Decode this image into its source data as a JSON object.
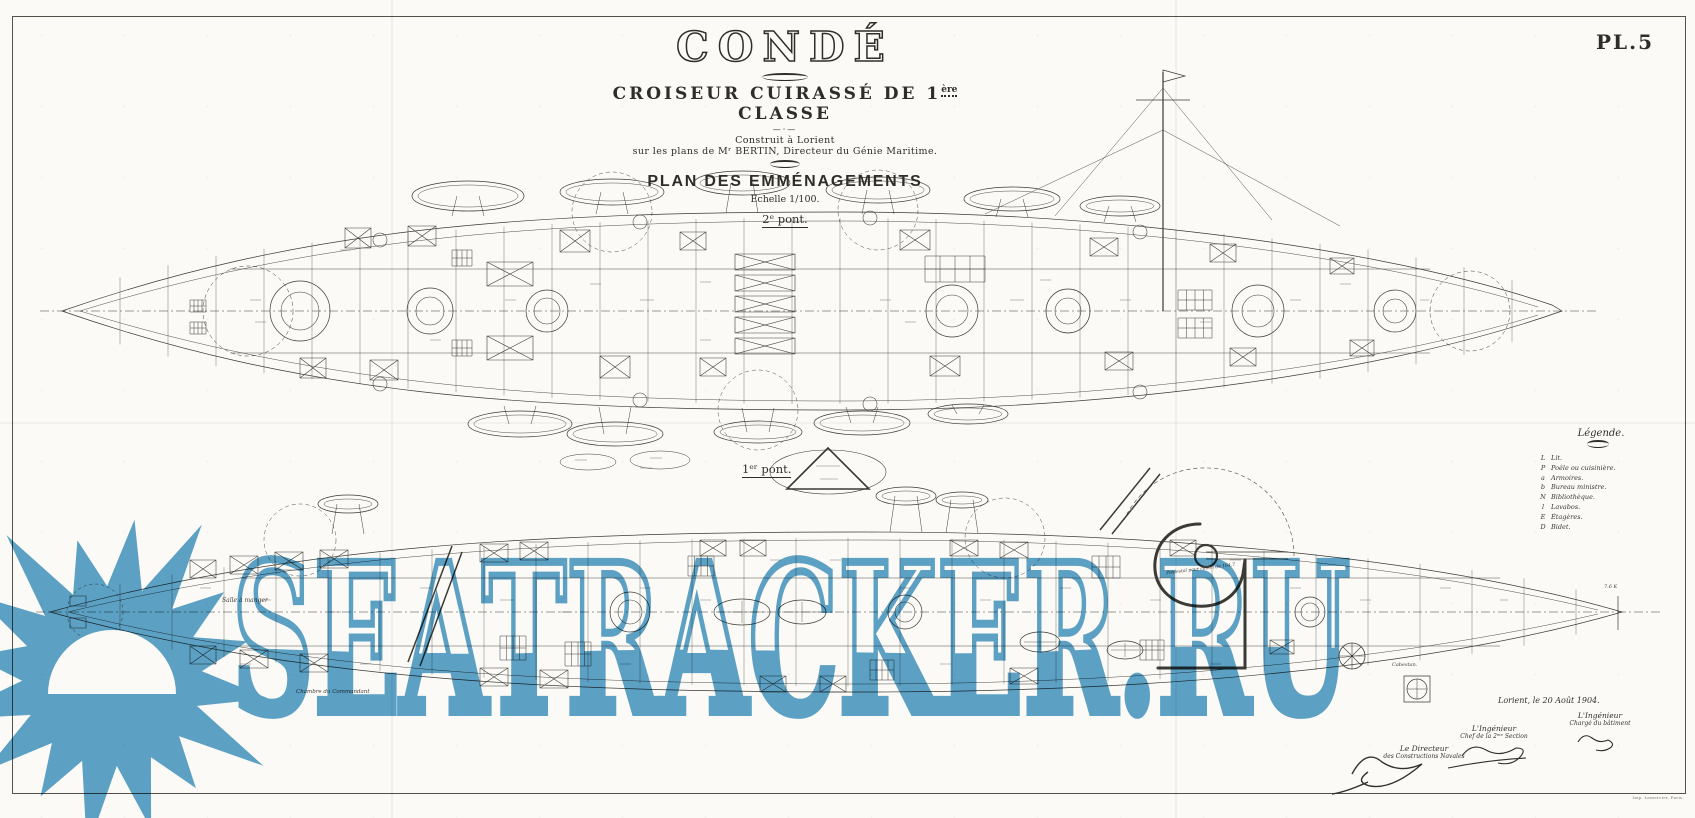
{
  "page": {
    "plate_number": "PL.5",
    "paper_color": "#fbfaf6",
    "ink_color": "#2f2d28",
    "imprint": "Imp. Lemercier, Paris."
  },
  "title_block": {
    "title": "CONDÉ",
    "subtitle_pre": "CROISEUR CUIRASSÉ DE 1",
    "subtitle_sup": "ère",
    "subtitle_post": " CLASSE",
    "built_line": "Construit à Lorient",
    "plans_line": "sur les plans de Mʳ BERTIN, Directeur du Génie Maritime.",
    "ornament": "—·—",
    "plan_title": "PLAN DES EMMÉNAGEMENTS",
    "scale_line": "Echelle 1/100.",
    "deck2_label": "2ᵉ pont.",
    "deck1_label": "1ᵉʳ pont."
  },
  "legend": {
    "title": "Légende.",
    "items": [
      {
        "key": "L",
        "label": "Lit."
      },
      {
        "key": "P",
        "label": "Poêle ou cuisinière."
      },
      {
        "key": "a",
        "label": "Armoires."
      },
      {
        "key": "b",
        "label": "Bureau ministre."
      },
      {
        "key": "N",
        "label": "Bibliothèque."
      },
      {
        "key": "l",
        "label": "Lavabos."
      },
      {
        "key": "E",
        "label": "Étagères."
      },
      {
        "key": "D",
        "label": "Bidet."
      }
    ]
  },
  "drawing_labels": {
    "salle_a_manger": "Salle à manger",
    "commandant": "Chambre du Commandant",
    "cabestan": "Cabestan.",
    "pedestal": "Piédestal pour canon de 164,7",
    "height_mark": "7.6 K"
  },
  "signatures": {
    "place_date": "Lorient, le 20 Août 1904.",
    "engineer_right_title": "L'Ingénieur",
    "engineer_right_sub": "Chargé du bâtiment",
    "engineer_mid_title": "L'Ingénieur",
    "engineer_mid_sub": "Chef de la 2ᵐᵉ Section",
    "director_title": "Le Directeur",
    "director_sub": "des Constructions Navales"
  },
  "watermark": {
    "text": "SEATRACKER.RU",
    "color": "#4f9bc7",
    "logo": "sun-over-sea-starburst"
  }
}
